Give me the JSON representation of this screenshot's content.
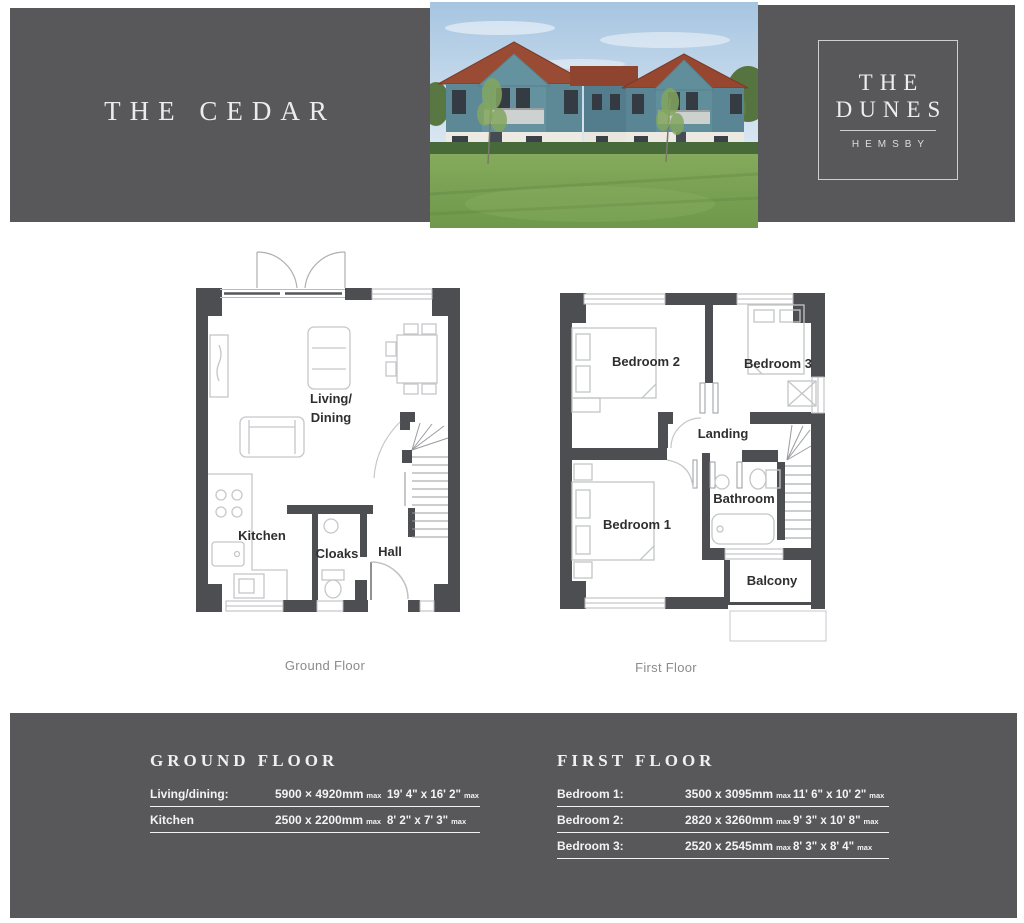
{
  "title": "THE CEDAR",
  "brand": {
    "line1": "THE",
    "line2": "DUNES",
    "subtitle": "HEMSBY"
  },
  "plans": {
    "ground": {
      "caption": "Ground Floor",
      "rooms": {
        "living1": "Living/",
        "living2": "Dining",
        "kitchen": "Kitchen",
        "cloaks": "Cloaks",
        "hall": "Hall"
      }
    },
    "first": {
      "caption": "First Floor",
      "rooms": {
        "bedroom2": "Bedroom 2",
        "bedroom3": "Bedroom 3",
        "landing": "Landing",
        "bathroom": "Bathroom",
        "bedroom1": "Bedroom 1",
        "balcony": "Balcony"
      }
    }
  },
  "footer": {
    "ground": {
      "heading": "GROUND FLOOR",
      "rows": [
        {
          "label": "Living/dining:",
          "metric": "5900 × 4920mm",
          "metric_suffix": "max",
          "imperial": "19' 4\" x 16' 2\"",
          "imperial_suffix": "max"
        },
        {
          "label": "Kitchen",
          "metric": "2500 x 2200mm",
          "metric_suffix": "max",
          "imperial": "8' 2\" x 7' 3\"",
          "imperial_suffix": "max"
        }
      ]
    },
    "first": {
      "heading": "FIRST FLOOR",
      "rows": [
        {
          "label": "Bedroom 1:",
          "metric": "3500 x 3095mm",
          "metric_suffix": "max",
          "imperial": "11' 6\" x 10' 2\"",
          "imperial_suffix": "max"
        },
        {
          "label": "Bedroom 2:",
          "metric": "2820 x 3260mm",
          "metric_suffix": "max",
          "imperial": "9' 3\" x 10' 8\"",
          "imperial_suffix": "max"
        },
        {
          "label": "Bedroom 3:",
          "metric": "2520 x 2545mm",
          "metric_suffix": "max",
          "imperial": "8' 3\" x 8' 4\"",
          "imperial_suffix": "max"
        }
      ]
    }
  },
  "colors": {
    "band": "#58585a",
    "wall": "#4d4e52",
    "room_label": "#2f2f31",
    "caption": "#8b8b8d",
    "footer_text": "#f3f3f4"
  }
}
